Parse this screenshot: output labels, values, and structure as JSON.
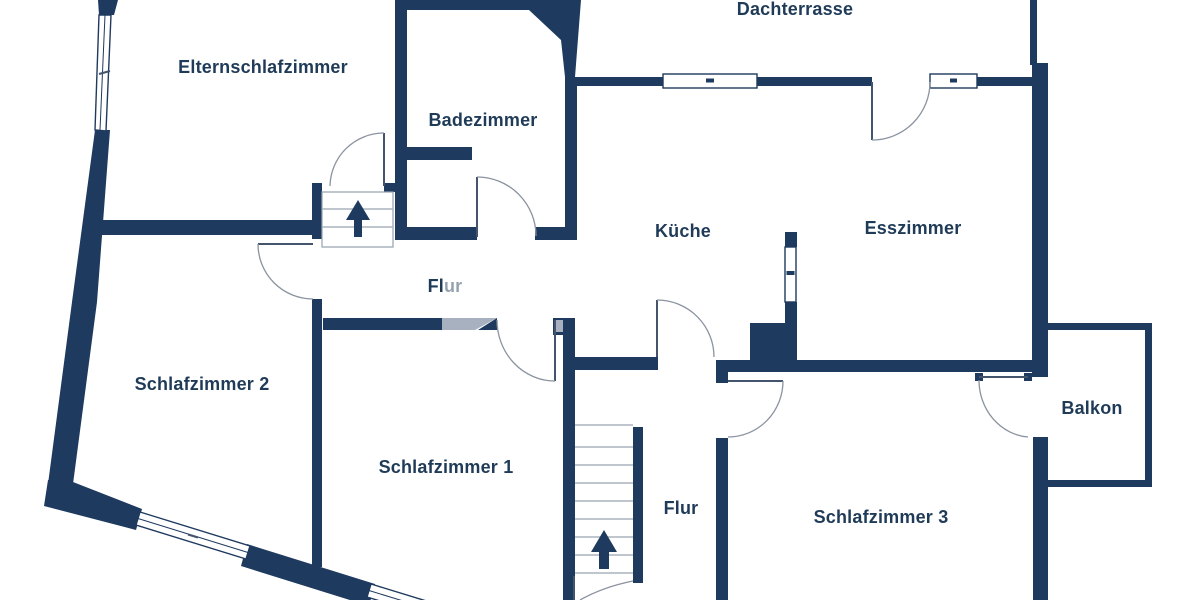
{
  "plan": {
    "kind": "apartment-floor-plan",
    "language": "de",
    "rooms": {
      "dachterrasse": {
        "label": "Dachterrasse"
      },
      "elternschlafzimmer": {
        "label": "Elternschlafzimmer"
      },
      "badezimmer": {
        "label": "Badezimmer"
      },
      "kueche": {
        "label": "Küche"
      },
      "esszimmer": {
        "label": "Esszimmer"
      },
      "flur_oben": {
        "label": "Flur"
      },
      "schlafzimmer_2": {
        "label": "Schlafzimmer 2"
      },
      "schlafzimmer_1": {
        "label": "Schlafzimmer 1"
      },
      "flur_unten": {
        "label": "Flur"
      },
      "schlafzimmer_3": {
        "label": "Schlafzimmer 3"
      },
      "balkon": {
        "label": "Balkon"
      }
    },
    "features": {
      "staircases": 2,
      "stair_direction": "up",
      "doors": 9,
      "windows": 6,
      "balcony": true,
      "roof_terrace": true
    }
  },
  "colors": {
    "wall": "#1e3a5e",
    "text": "#1f3b58",
    "door_arc": "#8b93a0",
    "door_leaf": "#44546c",
    "stair_line": "#aab3bd",
    "stair_border": "#97a1ad",
    "light_wall": "#a7b1bf"
  }
}
